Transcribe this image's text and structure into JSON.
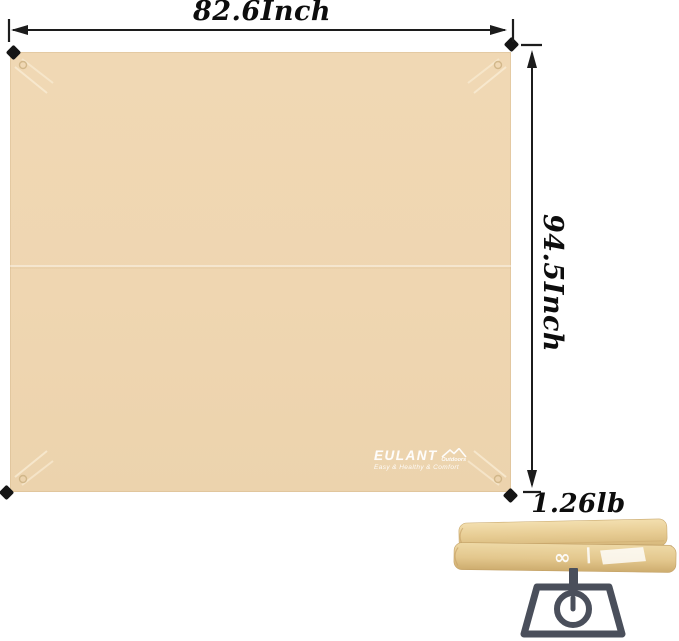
{
  "page": {
    "background_color": "#FFFFFF"
  },
  "labels": {
    "width": "82.6Inch",
    "height": "94.5Inch",
    "weight": "1.26lb"
  },
  "brand": {
    "name": "EULANT",
    "sub_brand": "Outdoors",
    "tagline": "Easy & Healthy & Comfort",
    "infinity_mark": "∞"
  },
  "colors": {
    "tarp_beige": "#EFD7B2",
    "folded_tarp_tan": "#E5C88F",
    "scale_icon_gray": "#4A4F5B",
    "stake_black": "#151515",
    "dimension_text": "#0D0D0D",
    "arrow_line": "#1C1C1C"
  }
}
